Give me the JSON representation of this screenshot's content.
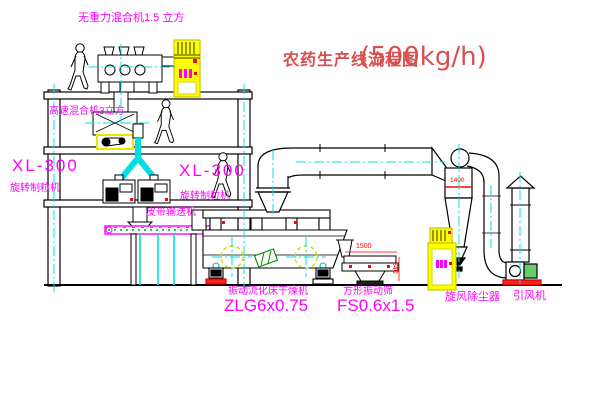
{
  "drawing": {
    "title": {
      "name": "农药生产线流程图",
      "capacity": "(500kg/h)"
    },
    "equipment_labels": {
      "gravity_free_mixer": "无重力混合机1.5 立方",
      "high_speed_mixer": "高速混合机3立方",
      "granulator_left": {
        "model": "XL-300",
        "name": "旋转制粒机"
      },
      "granulator_right": {
        "model": "XL-300",
        "name": "旋转制粒机"
      },
      "belt_conveyor": "皮带输送机",
      "fluid_bed_dryer": {
        "name": "振动流化床干燥机",
        "model": "ZLG6x0.75"
      },
      "square_sieve": {
        "name": "方形振动筛",
        "model": "FS0.6x1.5"
      },
      "cyclone": "旋风除尘器",
      "induced_draft_fan": "引风机"
    },
    "dimensions": {
      "cyclone": "1400",
      "sieve_length": "1500",
      "sieve_height": "340"
    },
    "colors": {
      "label_magenta": "#ff00ff",
      "title_red": "#d94f4f",
      "dimension_red": "#ff0000",
      "centerline_cyan": "#00e0e0",
      "cabinet_yellow": "#ffff00"
    }
  }
}
